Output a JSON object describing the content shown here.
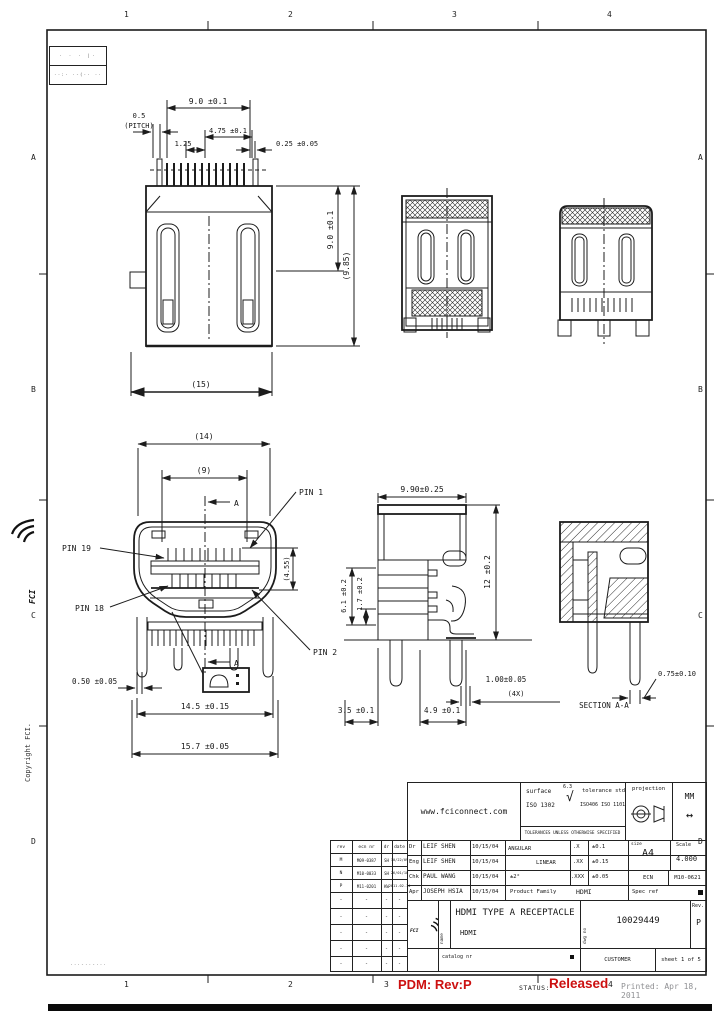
{
  "page": {
    "accent_red": "#cc1010",
    "line_color": "#1c1c1c",
    "printed_gray": "#8f9093"
  },
  "zones": {
    "top": [
      "1",
      "2",
      "3",
      "4"
    ],
    "bottom": [
      "1",
      "2",
      "3",
      "4"
    ],
    "left": [
      "A",
      "B",
      "C",
      "D"
    ],
    "right": [
      "A",
      "B",
      "C",
      "D"
    ]
  },
  "corner_table": {
    "row1": "· ·  ·  |·",
    "row2": "··:· ·-(·· ··"
  },
  "margin": {
    "logo_text": "FCI",
    "copyright": "Copyright FCI.",
    "footnote": "···-··-···"
  },
  "dims": {
    "rear": {
      "width": "9.0 ±0.1",
      "pitch_a": "0.5",
      "pitch_b": "(PITCH)",
      "d125": "1.25",
      "d475": "4.75 ±0.1",
      "d025": "0.25 ±0.05",
      "height": "9.0 ±0.1",
      "height_ref": "(9.85)",
      "overall": "(15)"
    },
    "front": {
      "w14": "(14)",
      "w9": "(9)",
      "pin1": "PIN 1",
      "pin19": "PIN 19",
      "pin18": "PIN 18",
      "pin2": "PIN 2",
      "h455": "(4.55)",
      "d050": "0.50 ±0.05",
      "d145": "14.5 ±0.15",
      "d157": "15.7 ±0.05",
      "sec": "A"
    },
    "side": {
      "w990": "9.90±0.25",
      "h61": "6.1 ±0.2",
      "h17": "1.7 ±0.2",
      "h12": "12 ±0.2",
      "d35": "3.5 ±0.1",
      "d49": "4.9 ±0.1",
      "d100": "1.00±0.05",
      "x4": "(4X)"
    },
    "section": {
      "d075": "0.75±0.10",
      "label": "SECTION A-A"
    }
  },
  "title_block": {
    "url": "www.fciconnect.com",
    "surface_label": "surface",
    "surface_std": "ISO 1302",
    "roughness": "6.3",
    "tolerance_label": "tolerance std",
    "tolerance_std": "ISO406 ISO 1101",
    "tol_note": "TOLERANCES UNLESS OTHERWISE SPECIFIED",
    "projection_label": "projection",
    "units": "MM",
    "units_arrow": "↔",
    "sign_rows": [
      {
        "role": "Dr",
        "name": "LEIF SHEN",
        "date": "10/15/04"
      },
      {
        "role": "Eng",
        "name": "LEIF SHEN",
        "date": "10/15/04"
      },
      {
        "role": "Chk",
        "name": "PAUL WANG",
        "date": "10/15/04"
      },
      {
        "role": "Apr",
        "name": "JOSEPH HSIA",
        "date": "10/15/04"
      }
    ],
    "angular_label": "ANGULAR",
    "linear_label": "LINEAR",
    "angular_tol": "±2°",
    "linear_tols": [
      {
        "k": ".X",
        "v": "±0.1"
      },
      {
        "k": ".XX",
        "v": "±0.15"
      },
      {
        "k": ".XXX",
        "v": "±0.05"
      }
    ],
    "size_label": "size",
    "size_value": "A4",
    "scale_label": "Scale",
    "scale_value": "4.000",
    "ecn_label": "ECN",
    "ecn_value": "M10-0621",
    "family_label": "Product Family",
    "family_value": "HDMI",
    "specref_label": "Spec ref",
    "name_col_label": "name",
    "logo_text": "FCI",
    "title": "HDMI TYPE A RECEPTACLE",
    "subtitle": "HDMI",
    "dwgno_label": "dwg no",
    "part_number": "10029449",
    "rev_label": "Rev.",
    "rev_value": "P",
    "catalog_label": "catalog nr",
    "customer_label": "CUSTOMER",
    "sheet_label": "sheet 1 of 5"
  },
  "rev_table": {
    "headers": [
      "rev",
      "ecn nr",
      "dr",
      "date"
    ],
    "rows": [
      [
        "M",
        "M09-0387",
        "SH",
        "10/22/09"
      ],
      [
        "N",
        "M10-0033",
        "SH",
        "26/01/10"
      ],
      [
        "P",
        "M11-0201",
        "KW",
        "2011-02-14"
      ],
      [
        "-",
        "-",
        "-",
        "-"
      ],
      [
        "-",
        "-",
        "-",
        "-"
      ],
      [
        "-",
        "-",
        "-",
        "-"
      ],
      [
        "-",
        "-",
        "-",
        "-"
      ],
      [
        "-",
        "-",
        "-",
        "-"
      ]
    ]
  },
  "status_bar": {
    "pdm": "PDM: Rev:P",
    "status_label": "STATUS:",
    "status_value": "Released",
    "printed": "Printed: Apr 18, 2011"
  }
}
